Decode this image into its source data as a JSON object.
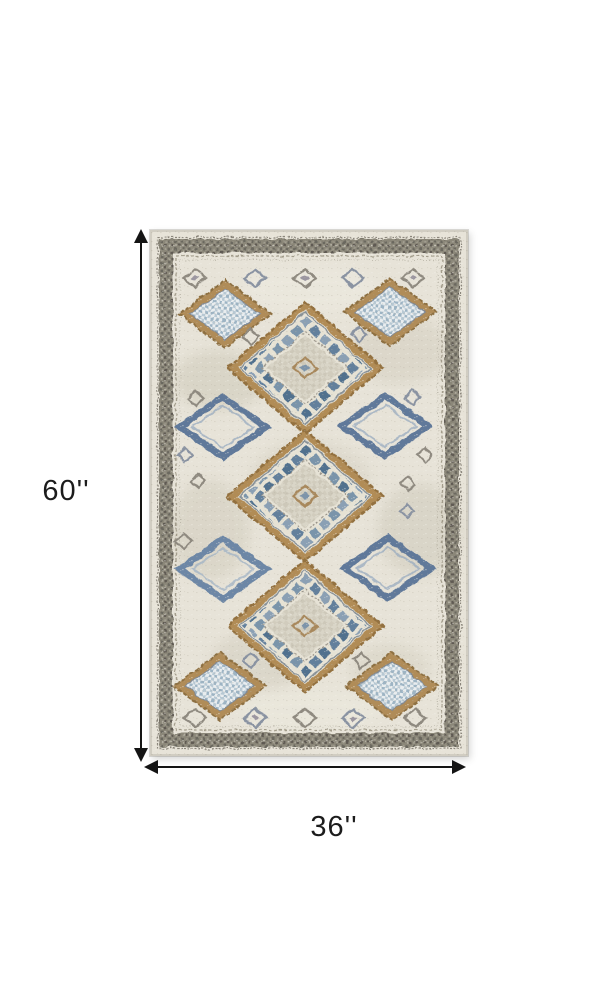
{
  "page": {
    "background_color": "#ffffff"
  },
  "diagram": {
    "type": "product-dimension-diagram",
    "product_name": "distressed diamond-medallion area rug",
    "height": {
      "label": "60''",
      "value": 60,
      "unit": "inches"
    },
    "width": {
      "label": "36''",
      "value": 36,
      "unit": "inches"
    },
    "arrow_color": "#141414",
    "label_color": "#1c1c1c"
  },
  "rug": {
    "field_color": "#e7e3d8",
    "border_band_color": "#7d7970",
    "accent_tan": "#b18c56",
    "accent_blue": "#617e9d",
    "accent_light_blue": "#c2d1dc",
    "pattern": "three stacked diamond medallions with corner and side diamond motifs"
  }
}
